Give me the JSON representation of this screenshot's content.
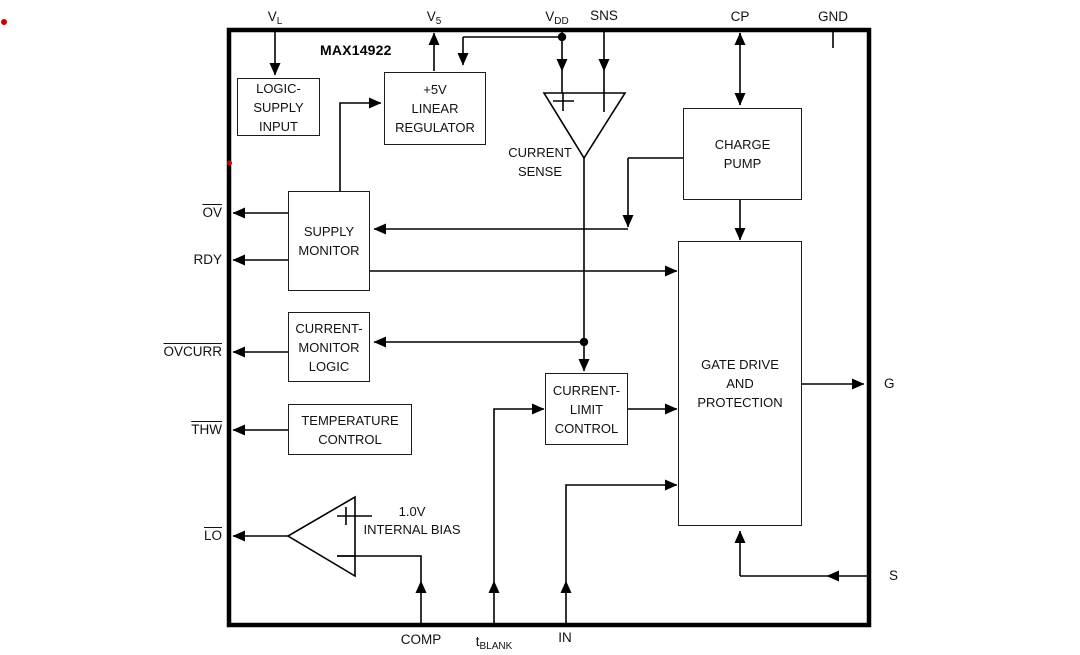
{
  "device": {
    "name": "MAX14922"
  },
  "pins": {
    "vl": {
      "base": "V",
      "sub": "L"
    },
    "v5": {
      "base": "V",
      "sub": "5"
    },
    "vdd": {
      "base": "V",
      "sub": "DD"
    },
    "sns": "SNS",
    "cp": "CP",
    "gnd": "GND",
    "ov": "OV",
    "rdy": "RDY",
    "ovcurr": "OVCURR",
    "thw": "THW",
    "lo": "LO",
    "g": "G",
    "s": "S",
    "comp": "COMP",
    "tblank": {
      "base": "t",
      "sub": "BLANK"
    },
    "in": "IN"
  },
  "blocks": {
    "logic_supply_input": "LOGIC-\nSUPPLY\nINPUT",
    "linear_regulator": "+5V\nLINEAR\nREGULATOR",
    "charge_pump": "CHARGE\nPUMP",
    "supply_monitor": "SUPPLY\nMONITOR",
    "current_monitor_logic": "CURRENT-\nMONITOR\nLOGIC",
    "temperature_control": "TEMPERATURE\nCONTROL",
    "current_limit_control": "CURRENT-\nLIMIT\nCONTROL",
    "gate_drive": "GATE DRIVE\nAND\nPROTECTION"
  },
  "amplifiers": {
    "current_sense": "CURRENT\nSENSE",
    "internal_bias": "1.0V\nINTERNAL BIAS"
  },
  "icons": {
    "plus_input": "+",
    "minus_input": "−"
  },
  "colors": {
    "line": "#000000",
    "box_border": "#1c1c1c",
    "annotation_dot": "#cc0000"
  }
}
